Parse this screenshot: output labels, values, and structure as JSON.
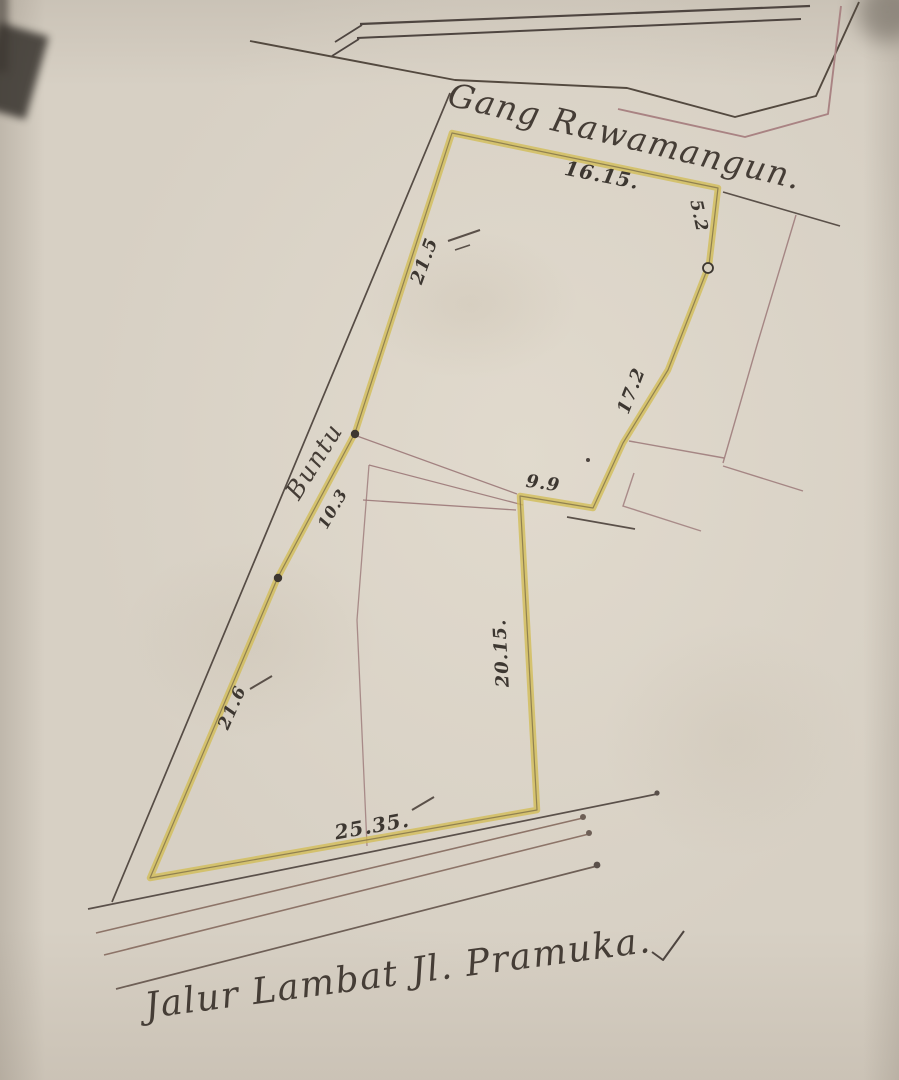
{
  "map": {
    "description": "Hand-drawn cadastral land plot sketch on aged paper",
    "streets": {
      "top": "Gang Rawamangun.",
      "bottom": "Jalur Lambat Jl. Pramuka."
    },
    "alley_label": "Buntu",
    "plot_boundary_measurements": {
      "north_front_gang_rawamangun": "16.15.",
      "northeast_upper": "5.2",
      "east": "17.2",
      "east_jog": "9.9",
      "southeast_lower": "20.15.",
      "south_front_jl_pramuka": "25.35.",
      "southwest": "21.6",
      "west_middle": "10.3",
      "northwest": "21.5"
    },
    "markers": {
      "filled_dots_on_boundary": 2,
      "open_circle_on_east_edge": 1,
      "road_line_end_dots": 4
    }
  },
  "colors": {
    "paper": "#d7d0c4",
    "ink_dark": "#4e4540",
    "ink_red": "#a98383",
    "highlight_yellow": "#d2bd55",
    "handwriting": "#3d3731"
  },
  "labels": [
    {
      "id": "street-gang-rawamangun",
      "text": "Gang Rawamangun.",
      "x": 625,
      "y": 136,
      "rot": 13.5,
      "size": 33,
      "cls": "script"
    },
    {
      "id": "street-jalur-lambat",
      "text": "Jalur Lambat Jl. Pramuka.",
      "x": 398,
      "y": 974,
      "rot": -7.5,
      "size": 36,
      "cls": "script"
    },
    {
      "id": "label-buntu",
      "text": "Buntu",
      "x": 314,
      "y": 461,
      "rot": -58,
      "size": 25,
      "cls": "script"
    },
    {
      "id": "dim-16-15",
      "text": "16.15.",
      "x": 602,
      "y": 175,
      "rot": 11,
      "size": 20,
      "cls": "dim"
    },
    {
      "id": "dim-5-2",
      "text": "5.2",
      "x": 698,
      "y": 216,
      "rot": 78,
      "size": 17,
      "cls": "dim"
    },
    {
      "id": "dim-21-5",
      "text": "21.5",
      "x": 425,
      "y": 261,
      "rot": -70,
      "size": 18,
      "cls": "dim"
    },
    {
      "id": "dim-17-2",
      "text": "17.2",
      "x": 632,
      "y": 391,
      "rot": -69,
      "size": 18,
      "cls": "dim"
    },
    {
      "id": "dim-9-9",
      "text": "9.9",
      "x": 543,
      "y": 484,
      "rot": 8,
      "size": 18,
      "cls": "dim"
    },
    {
      "id": "dim-10-3",
      "text": "10.3",
      "x": 333,
      "y": 509,
      "rot": -60,
      "size": 16,
      "cls": "dim"
    },
    {
      "id": "dim-20-15",
      "text": "20.15.",
      "x": 502,
      "y": 653,
      "rot": -93,
      "size": 18,
      "cls": "dim"
    },
    {
      "id": "dim-21-6",
      "text": "21.6",
      "x": 233,
      "y": 708,
      "rot": -66,
      "size": 17,
      "cls": "dim"
    },
    {
      "id": "dim-25-35",
      "text": "25.35.",
      "x": 372,
      "y": 826,
      "rot": -10,
      "size": 20,
      "cls": "dim"
    }
  ]
}
